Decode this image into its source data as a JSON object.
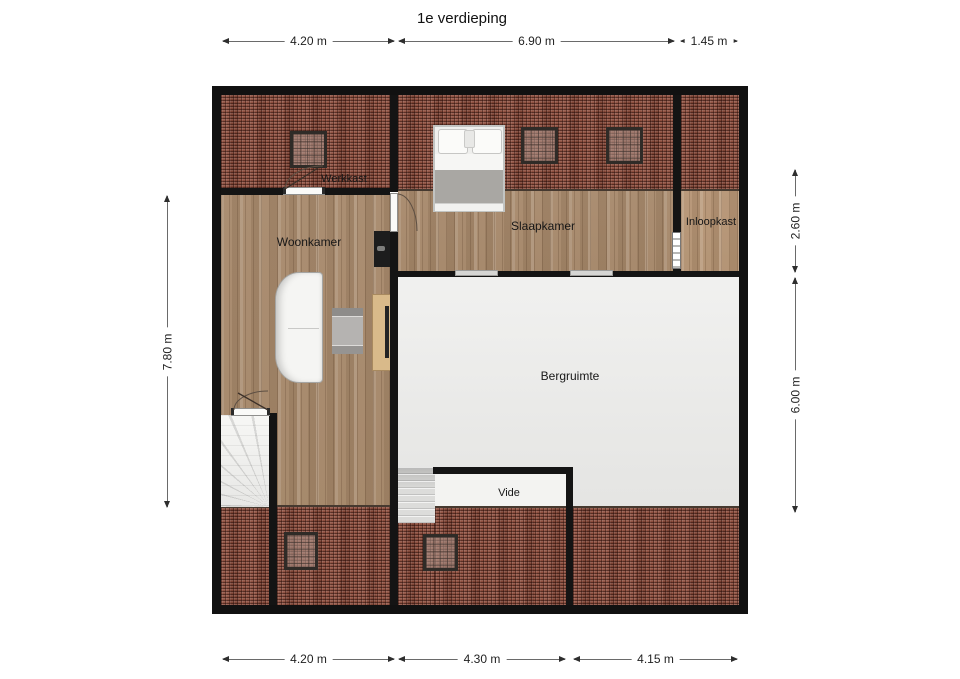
{
  "title": "1e verdieping",
  "rooms": {
    "werkkast": "Werkkast",
    "woonkamer": "Woonkamer",
    "slaapkamer": "Slaapkamer",
    "inloopkast": "Inloopkast",
    "bergruimte": "Bergruimte",
    "vide": "Vide"
  },
  "dimensions": {
    "top": [
      "4.20 m",
      "6.90 m",
      "1.45 m"
    ],
    "bottom": [
      "4.20 m",
      "4.30 m",
      "4.15 m"
    ],
    "left": [
      "7.80 m"
    ],
    "right": [
      "2.60 m",
      "6.00 m"
    ]
  },
  "colors": {
    "roof_tiles": "#8b4b3a",
    "wood_floor": "#a78a6d",
    "storage_floor": "#e9e9e7",
    "wall": "#141414",
    "background": "#ffffff"
  }
}
